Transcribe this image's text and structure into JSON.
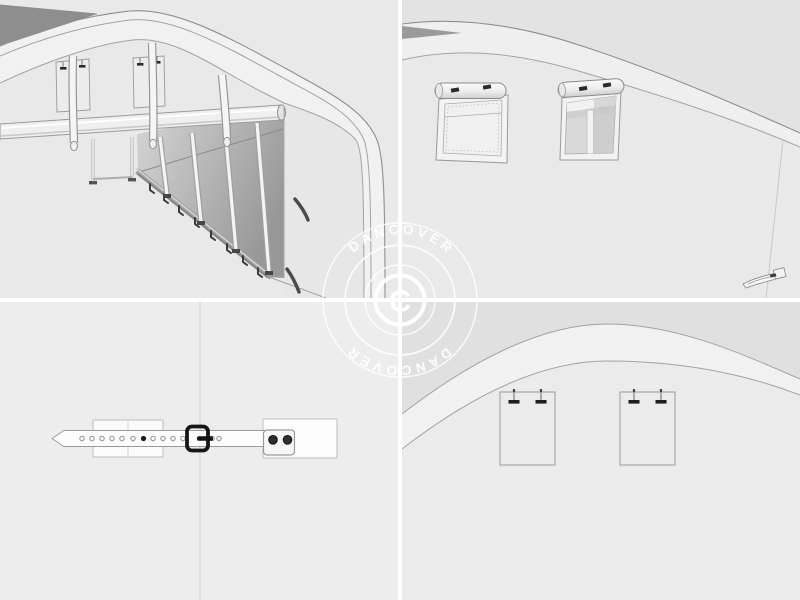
{
  "watermark": {
    "brand_top": "DANCOVER",
    "brand_bottom": "DANCOVER",
    "copyright_letter": "C"
  },
  "colors": {
    "divider": "#ffffff",
    "bg_top_left": "#e9e9e9",
    "bg_top_right": "#e9e9e9",
    "bg_bottom_left": "#ededed",
    "bg_bottom_right": "#ebebeb",
    "roof_dark": "#8e8e8e",
    "roof_sliver_dark": "#9a9a9a",
    "rim_light": "#f1f1f1",
    "band_above_curve": "#e0e0e0",
    "wall_gradient_start": "#d6d6d6",
    "wall_gradient_end": "#989898",
    "right_face": "#e7e7e7",
    "hardware_dark": "#2b2b2b",
    "buckle_black": "#161616",
    "watermark_white": "#ffffff"
  }
}
